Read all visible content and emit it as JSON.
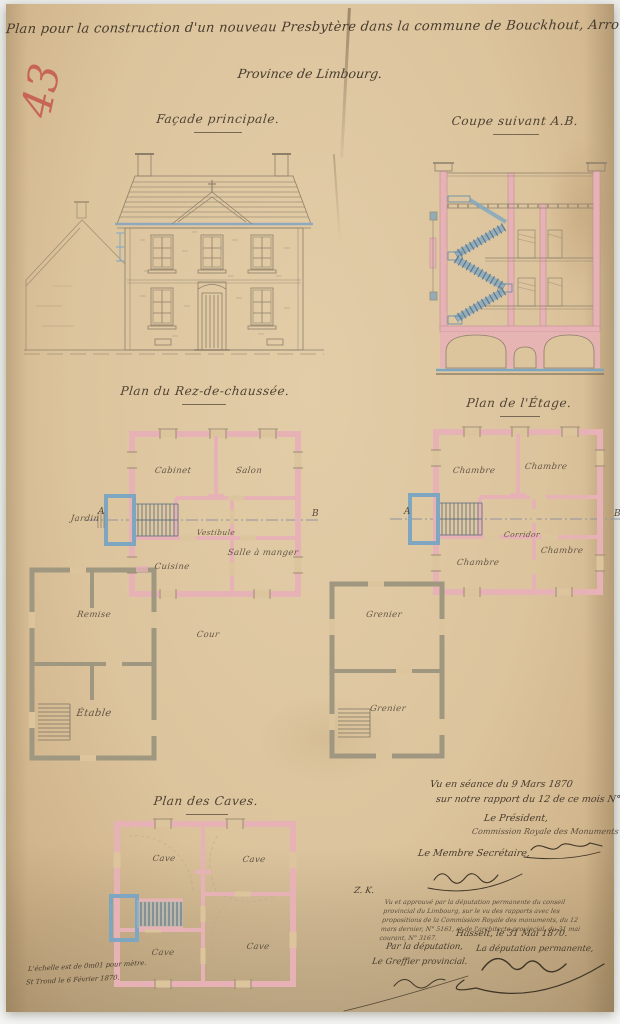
{
  "colors": {
    "paper": "#dcc49d",
    "wall_pink": "#e7b2b5",
    "stair_blue": "#7fa6c0",
    "outbuilding_gray": "#a09780",
    "ink": "#4a3e2f",
    "pencil": "#8d7f6a",
    "red_crayon": "#c5564e"
  },
  "archive_number": "43",
  "title": {
    "line1": "Plan pour la construction d'un nouveau Presbytère dans la commune de Bouckhout, Arrondissement de Hasselt",
    "line2": "Province de Limbourg."
  },
  "facade": {
    "title": "Façade principale."
  },
  "coupe": {
    "title": "Coupe suivant A.B."
  },
  "rdc": {
    "title": "Plan du Rez-de-chaussée.",
    "rooms": [
      "Cabinet",
      "Salon",
      "Vestibule",
      "Salle à manger",
      "Cuisine"
    ],
    "outside": "Jardin",
    "court": "Cour",
    "annex_rooms": [
      "Remise",
      "Étable"
    ],
    "marker_a": "A",
    "marker_b": "B"
  },
  "etage": {
    "title": "Plan de l'Étage.",
    "rooms": [
      "Chambre",
      "Chambre",
      "Corridor",
      "Chambre",
      "Chambre"
    ],
    "annex_rooms": [
      "Grenier",
      "Grenier"
    ],
    "marker_a": "A",
    "marker_b": "B"
  },
  "caves": {
    "title": "Plan des Caves.",
    "rooms": [
      "Cave",
      "Cave",
      "Cave",
      "Cave"
    ]
  },
  "approvals": {
    "seance_line1": "Vu en séance du 9 Mars 1870",
    "seance_line2": "sur notre rapport du 12 de ce mois N° 5161.",
    "president_title": "Le Président,",
    "commission": "Commission Royale des Monuments",
    "secretary_title": "Le Membre Secrétaire,",
    "ref_mark": "Z. K.",
    "deputation_note_l1": "Vu et approuvé par la députation permanente du conseil provincial du Limbourg, sur le vu des",
    "deputation_note_l2": "rapports avec les propositions de la Commission Royale des monuments, du 12 mars dernier, N° 5161, et de",
    "deputation_note_l3": "l'architecte provincial, du 31 mai courant, N° 3167.",
    "place_date": "Hasselt, le 31 Mai 1870.",
    "deputation_title": "La députation permanente,",
    "par_deputation": "Par la députation,",
    "greffier_title": "Le Greffier provincial."
  },
  "scale_note": {
    "line1": "L'échelle est de 0m01 pour mètre.",
    "line2": "St Trond le 6 Février 1870."
  }
}
